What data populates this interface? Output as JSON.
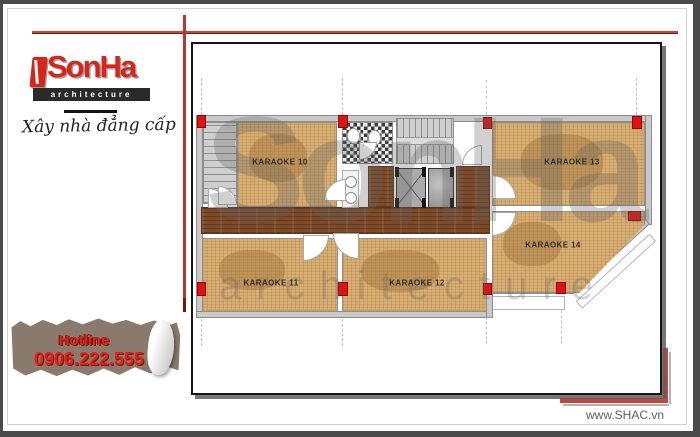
{
  "branding": {
    "logo_text": "SonHa",
    "logo_subtext": "architecture",
    "tagline": "Xây nhà đẳng cấp",
    "accent_red": "#d8251c"
  },
  "hotline": {
    "label": "Hotline",
    "number": "0906.222.555"
  },
  "footer": {
    "website": "www.SHAC.vn"
  },
  "watermark": {
    "line1": "SonHa",
    "line2": "architecture"
  },
  "plan": {
    "rooms": [
      {
        "id": "karaoke-10",
        "label": "KARAOKE 10"
      },
      {
        "id": "karaoke-11",
        "label": "KARAOKE 11"
      },
      {
        "id": "karaoke-12",
        "label": "KARAOKE 12"
      },
      {
        "id": "karaoke-13",
        "label": "KARAOKE 13"
      },
      {
        "id": "karaoke-14",
        "label": "KARAOKE 14"
      }
    ],
    "colors": {
      "column_marker": "#e01212",
      "wood_light": "#d7ae74",
      "wood_dark": "#7c4a28",
      "wall_gray": "#c9c9c9"
    }
  }
}
